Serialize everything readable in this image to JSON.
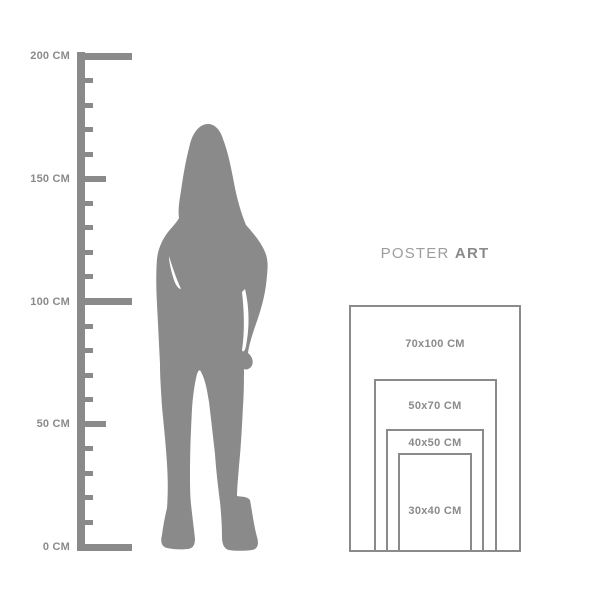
{
  "colors": {
    "gray": "#8a8a8a",
    "light_gray": "#9d9d9d",
    "background": "#ffffff"
  },
  "ruler": {
    "unit": "CM",
    "max_cm": 200,
    "tick_interval_cm": 10,
    "labels": [
      {
        "cm": 200,
        "text": "200 CM"
      },
      {
        "cm": 150,
        "text": "150 CM"
      },
      {
        "cm": 100,
        "text": "100 CM"
      },
      {
        "cm": 50,
        "text": "50 CM"
      },
      {
        "cm": 0,
        "text": "0 CM"
      }
    ]
  },
  "figure": {
    "icon": "standing-woman-silhouette"
  },
  "brand": {
    "poster": "POSTER",
    "art": "ART"
  },
  "posters": {
    "sizes": [
      {
        "label": "70x100 CM",
        "w_cm": 70,
        "h_cm": 100
      },
      {
        "label": "50x70 CM",
        "w_cm": 50,
        "h_cm": 70
      },
      {
        "label": "40x50 CM",
        "w_cm": 40,
        "h_cm": 50
      },
      {
        "label": "30x40 CM",
        "w_cm": 30,
        "h_cm": 40
      }
    ]
  }
}
